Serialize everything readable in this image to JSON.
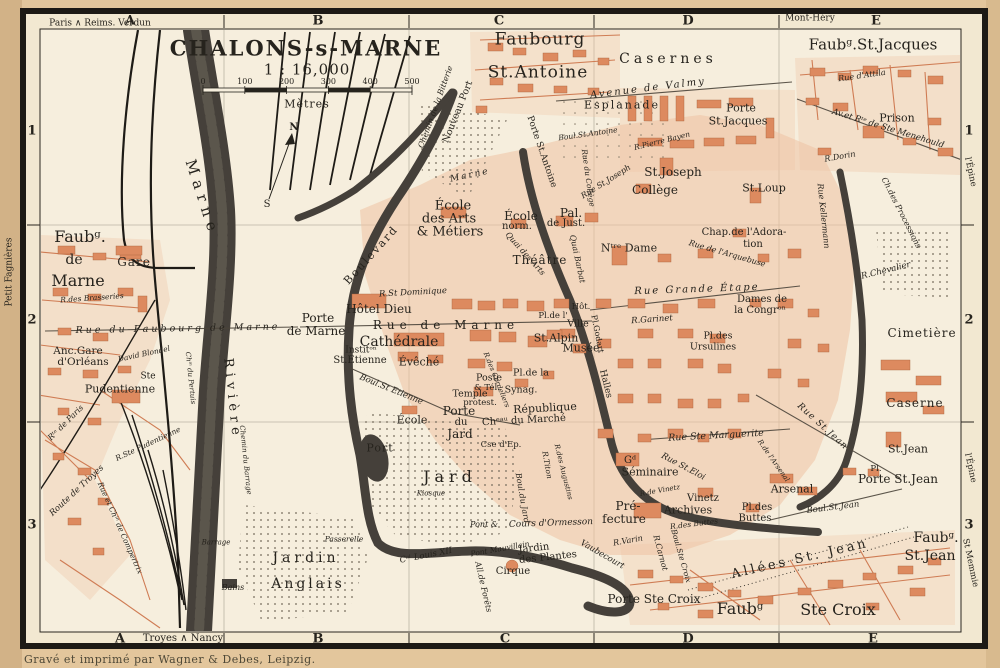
{
  "title": {
    "name": "CHALONS-s-MARNE",
    "scale": "1 : 16,000",
    "unit": "Mètres"
  },
  "scale_bar": {
    "ticks": [
      "0",
      "100",
      "200",
      "300",
      "400",
      "500"
    ]
  },
  "margins": {
    "credit": "Gravé et imprimé par Wagner & Debes, Leipzig."
  },
  "grid": {
    "cols": [
      "A",
      "B",
      "C",
      "D",
      "E"
    ],
    "col_x_top": [
      130,
      318,
      499,
      688,
      876
    ],
    "col_x_bottom": [
      120,
      318,
      505,
      688,
      873
    ],
    "rows": [
      "1",
      "2",
      "3"
    ],
    "row_y": [
      131,
      320,
      525
    ],
    "row_x_left": 32,
    "row_x_right": 969
  },
  "colors": {
    "paper": "#e3c69c",
    "sheet": "#f2e8d1",
    "field": "#f6eedd",
    "building": "#dd8a5f",
    "city_wash": "#efc3a2",
    "water": "#45403a",
    "ink": "#26231d",
    "red_ink": "#cf7c54"
  },
  "labels": [
    {
      "t": "Paris ∧ Reims. Verdun",
      "x": 100,
      "y": 24,
      "s": 9
    },
    {
      "t": "Mont-Héry",
      "x": 810,
      "y": 19,
      "s": 9
    },
    {
      "t": "Troyes ∧ Nancy",
      "x": 183,
      "y": 639,
      "s": 10
    },
    {
      "t": "Petit Fagnières",
      "x": 10,
      "y": 272,
      "s": 9,
      "r": -90
    },
    {
      "t": "l'Épine",
      "x": 970,
      "y": 172,
      "s": 8.5,
      "r": 78
    },
    {
      "t": "l'Épine",
      "x": 970,
      "y": 468,
      "s": 8.5,
      "r": 78
    },
    {
      "t": "St Memmie",
      "x": 970,
      "y": 563,
      "s": 8.5,
      "r": 78
    },
    {
      "t": "N",
      "x": 294,
      "y": 128,
      "s": 10,
      "b": 1
    },
    {
      "t": "S",
      "x": 267,
      "y": 205,
      "s": 10
    },
    {
      "t": "Faubourg",
      "x": 540,
      "y": 40,
      "s": 17,
      "ls": 1
    },
    {
      "t": "St.Antoine",
      "x": 538,
      "y": 73,
      "s": 17,
      "ls": 1
    },
    {
      "t": "Casernes",
      "x": 668,
      "y": 59,
      "s": 14,
      "ls": 4
    },
    {
      "t": "Faubᵍ.St.Jacques",
      "x": 873,
      "y": 45,
      "s": 15
    },
    {
      "t": "Rue d'Attila",
      "x": 862,
      "y": 76,
      "s": 8,
      "i": 1,
      "r": -8
    },
    {
      "t": "Avenue de Valmy",
      "x": 648,
      "y": 89,
      "s": 10,
      "i": 1,
      "r": -7,
      "ls": 2
    },
    {
      "t": "Esplanade",
      "x": 622,
      "y": 105,
      "s": 11,
      "ls": 2
    },
    {
      "t": "Porte",
      "x": 741,
      "y": 108,
      "s": 11
    },
    {
      "t": "St.Jacques",
      "x": 738,
      "y": 121,
      "s": 11
    },
    {
      "t": "Prison",
      "x": 897,
      "y": 118,
      "s": 11
    },
    {
      "t": "Av.et Rᵗᵉ de Ste Menehould",
      "x": 888,
      "y": 129,
      "s": 8.5,
      "i": 1,
      "r": 17
    },
    {
      "t": "Boul.St.Antoine",
      "x": 588,
      "y": 134,
      "s": 7.5,
      "i": 1,
      "r": -8
    },
    {
      "t": "R.Pierre Bayen",
      "x": 662,
      "y": 141,
      "s": 7.5,
      "i": 1,
      "r": -14
    },
    {
      "t": "Porte St.Antoine",
      "x": 541,
      "y": 152,
      "s": 9,
      "r": 71
    },
    {
      "t": "St.Joseph",
      "x": 673,
      "y": 172,
      "s": 12
    },
    {
      "t": "Collège",
      "x": 655,
      "y": 190,
      "s": 12
    },
    {
      "t": "Rue St.Joseph",
      "x": 606,
      "y": 182,
      "s": 8,
      "i": 1,
      "r": -32
    },
    {
      "t": "St.Loup",
      "x": 764,
      "y": 188,
      "s": 11
    },
    {
      "t": "R.Dorin",
      "x": 840,
      "y": 157,
      "s": 8,
      "i": 1,
      "r": -10
    },
    {
      "t": "Rue Kellermann",
      "x": 823,
      "y": 216,
      "s": 8,
      "i": 1,
      "r": 84
    },
    {
      "t": "Ch.des Processions",
      "x": 901,
      "y": 213,
      "s": 8,
      "i": 1,
      "r": 63
    },
    {
      "t": "R.Chevalier",
      "x": 886,
      "y": 271,
      "s": 8.5,
      "i": 1,
      "r": -14
    },
    {
      "t": "Chap.de l'Adora-",
      "x": 744,
      "y": 233,
      "s": 10
    },
    {
      "t": "tion",
      "x": 753,
      "y": 245,
      "s": 10
    },
    {
      "t": "Nᵗʳᵉ Dame",
      "x": 629,
      "y": 248,
      "s": 11
    },
    {
      "t": "Rue de l'Arquebuse",
      "x": 727,
      "y": 254,
      "s": 8,
      "i": 1,
      "r": 16
    },
    {
      "t": "Rue Grande Étape",
      "x": 697,
      "y": 290,
      "s": 10,
      "i": 1,
      "ls": 2,
      "r": -2
    },
    {
      "t": "Dames de",
      "x": 762,
      "y": 300,
      "s": 10
    },
    {
      "t": "la Congrᵒⁿ",
      "x": 760,
      "y": 311,
      "s": 10
    },
    {
      "t": "R.Garinet",
      "x": 652,
      "y": 320,
      "s": 8.5,
      "i": 1,
      "r": -4
    },
    {
      "t": "Pl.des",
      "x": 718,
      "y": 336,
      "s": 9.5
    },
    {
      "t": "Ursulines",
      "x": 713,
      "y": 347,
      "s": 9.5
    },
    {
      "t": "Cimetière",
      "x": 922,
      "y": 333,
      "s": 12,
      "ls": 1
    },
    {
      "t": "Caserne",
      "x": 915,
      "y": 403,
      "s": 12,
      "ls": 1
    },
    {
      "t": "St.Jean",
      "x": 908,
      "y": 449,
      "s": 11
    },
    {
      "t": "Pl.",
      "x": 876,
      "y": 469,
      "s": 8.5
    },
    {
      "t": "Porte St.Jean",
      "x": 898,
      "y": 479,
      "s": 12
    },
    {
      "t": "Arsenal",
      "x": 792,
      "y": 489,
      "s": 11
    },
    {
      "t": "Boul.St.Jean",
      "x": 833,
      "y": 508,
      "s": 8.5,
      "i": 1,
      "r": -7
    },
    {
      "t": "Rue St.Jean",
      "x": 822,
      "y": 427,
      "s": 9,
      "i": 1,
      "r": 42,
      "ls": 1
    },
    {
      "t": "R.de l'Arsenal",
      "x": 773,
      "y": 461,
      "s": 7,
      "i": 1,
      "r": 55
    },
    {
      "t": "Rue Ste Marguerite",
      "x": 716,
      "y": 436,
      "s": 9.5,
      "i": 1,
      "r": -3
    },
    {
      "t": "Rue St.Eloi",
      "x": 683,
      "y": 467,
      "s": 8.5,
      "i": 1,
      "r": 28
    },
    {
      "t": "Gᵈ",
      "x": 630,
      "y": 461,
      "s": 10
    },
    {
      "t": "Séminaire",
      "x": 650,
      "y": 472,
      "s": 11
    },
    {
      "t": "R.de Vinetz",
      "x": 660,
      "y": 491,
      "s": 7,
      "i": 1,
      "r": -10
    },
    {
      "t": "Vinetz",
      "x": 703,
      "y": 499,
      "s": 10
    },
    {
      "t": "Archives",
      "x": 688,
      "y": 510,
      "s": 11
    },
    {
      "t": "Pré-",
      "x": 628,
      "y": 506,
      "s": 12
    },
    {
      "t": "fecture",
      "x": 624,
      "y": 519,
      "s": 12
    },
    {
      "t": "Pl.des",
      "x": 757,
      "y": 508,
      "s": 10
    },
    {
      "t": "Buttes",
      "x": 755,
      "y": 519,
      "s": 10
    },
    {
      "t": "R.des Buttes",
      "x": 694,
      "y": 524,
      "s": 7.5,
      "i": 1,
      "r": -7
    },
    {
      "t": "R.Varin",
      "x": 628,
      "y": 541,
      "s": 8,
      "i": 1,
      "r": -10
    },
    {
      "t": "Vaubecourt",
      "x": 602,
      "y": 555,
      "s": 8.5,
      "i": 1,
      "r": 30
    },
    {
      "t": "R.Carnot",
      "x": 660,
      "y": 553,
      "s": 8,
      "i": 1,
      "r": 75
    },
    {
      "t": "Boul.Ste Croix",
      "x": 681,
      "y": 556,
      "s": 7.5,
      "i": 1,
      "r": 74
    },
    {
      "t": "Porte Ste Croix",
      "x": 654,
      "y": 599,
      "s": 12
    },
    {
      "t": "Faubᵍ",
      "x": 740,
      "y": 609,
      "s": 16
    },
    {
      "t": "Ste Croix",
      "x": 838,
      "y": 610,
      "s": 16
    },
    {
      "t": "Allées St. Jean",
      "x": 800,
      "y": 559,
      "s": 13,
      "ls": 3,
      "r": -13
    },
    {
      "t": "Faubᵍ.",
      "x": 936,
      "y": 538,
      "s": 14
    },
    {
      "t": "St.Jean",
      "x": 930,
      "y": 556,
      "s": 14
    },
    {
      "t": "Cours d'Ormesson",
      "x": 551,
      "y": 524,
      "s": 9,
      "i": 1,
      "r": -2
    },
    {
      "t": "Pont &",
      "x": 484,
      "y": 525,
      "s": 8,
      "i": 1
    },
    {
      "t": "Pont Mauvillain",
      "x": 500,
      "y": 549,
      "s": 7.5,
      "i": 1,
      "r": -10
    },
    {
      "t": "Jardin",
      "x": 534,
      "y": 549,
      "s": 10,
      "r": -6
    },
    {
      "t": "des Plantes",
      "x": 548,
      "y": 558,
      "s": 10,
      "r": -6
    },
    {
      "t": "Cirque",
      "x": 513,
      "y": 572,
      "s": 10
    },
    {
      "t": "All.de Forêts",
      "x": 483,
      "y": 587,
      "s": 8,
      "i": 1,
      "r": 77
    },
    {
      "t": "Cᵃˡ Louis XII",
      "x": 426,
      "y": 556,
      "s": 8.5,
      "i": 1,
      "r": -11
    },
    {
      "t": "Passerelle",
      "x": 344,
      "y": 539,
      "s": 7.5,
      "i": 1
    },
    {
      "t": "Jardin",
      "x": 306,
      "y": 558,
      "s": 14,
      "ls": 4
    },
    {
      "t": "Anglais",
      "x": 308,
      "y": 584,
      "s": 14,
      "ls": 3
    },
    {
      "t": "Kiosque",
      "x": 431,
      "y": 494,
      "s": 7,
      "i": 1
    },
    {
      "t": "Jard",
      "x": 450,
      "y": 477,
      "s": 16,
      "ls": 5
    },
    {
      "t": "Porte",
      "x": 459,
      "y": 411,
      "s": 12
    },
    {
      "t": "du",
      "x": 461,
      "y": 423,
      "s": 10
    },
    {
      "t": "Jard",
      "x": 460,
      "y": 434,
      "s": 12
    },
    {
      "t": "École",
      "x": 412,
      "y": 420,
      "s": 11
    },
    {
      "t": "Chᵉᵃᵘ du Marché",
      "x": 524,
      "y": 421,
      "s": 10,
      "r": -3
    },
    {
      "t": "Cse d'Ep.",
      "x": 501,
      "y": 445,
      "s": 8.5
    },
    {
      "t": "Port",
      "x": 380,
      "y": 448,
      "s": 11,
      "ls": 1
    },
    {
      "t": "Poste",
      "x": 489,
      "y": 378,
      "s": 9.5
    },
    {
      "t": "& Tél.",
      "x": 487,
      "y": 388,
      "s": 8.5
    },
    {
      "t": "Temple",
      "x": 470,
      "y": 394,
      "s": 9.5
    },
    {
      "t": "protest.",
      "x": 480,
      "y": 403,
      "s": 8.5
    },
    {
      "t": "Pl.de la",
      "x": 531,
      "y": 373,
      "s": 9.5
    },
    {
      "t": "Synag.",
      "x": 521,
      "y": 390,
      "s": 9.5
    },
    {
      "t": "République",
      "x": 545,
      "y": 408,
      "s": 11,
      "r": -3
    },
    {
      "t": "Halles",
      "x": 605,
      "y": 384,
      "s": 9,
      "r": 76
    },
    {
      "t": "Pl.Godart",
      "x": 597,
      "y": 334,
      "s": 8,
      "r": 79
    },
    {
      "t": "Pl.de l'",
      "x": 553,
      "y": 316,
      "s": 8.5
    },
    {
      "t": "Hôt.",
      "x": 581,
      "y": 307,
      "s": 8.5
    },
    {
      "t": "Ville",
      "x": 578,
      "y": 324,
      "s": 9.5
    },
    {
      "t": "St.Alpin",
      "x": 556,
      "y": 338,
      "s": 11
    },
    {
      "t": "Musée",
      "x": 581,
      "y": 348,
      "s": 11
    },
    {
      "t": "Théâtre",
      "x": 540,
      "y": 260,
      "s": 12,
      "ls": 1
    },
    {
      "t": "Pal.",
      "x": 571,
      "y": 213,
      "s": 12
    },
    {
      "t": "de Just.",
      "x": 566,
      "y": 224,
      "s": 10
    },
    {
      "t": "École",
      "x": 521,
      "y": 216,
      "s": 12
    },
    {
      "t": "norm.",
      "x": 517,
      "y": 227,
      "s": 10
    },
    {
      "t": "École",
      "x": 453,
      "y": 206,
      "s": 13
    },
    {
      "t": "des Arts",
      "x": 449,
      "y": 219,
      "s": 13
    },
    {
      "t": "& Métiers",
      "x": 450,
      "y": 232,
      "s": 13
    },
    {
      "t": "Boulevard",
      "x": 371,
      "y": 255,
      "s": 11,
      "r": -48,
      "ls": 2
    },
    {
      "t": "R.St Dominique",
      "x": 413,
      "y": 293,
      "s": 8.5,
      "i": 1,
      "r": -3
    },
    {
      "t": "Hôtel Dieu",
      "x": 379,
      "y": 309,
      "s": 12
    },
    {
      "t": "Porte",
      "x": 318,
      "y": 318,
      "s": 12
    },
    {
      "t": "de Marne",
      "x": 316,
      "y": 331,
      "s": 12
    },
    {
      "t": "Rue de Marne",
      "x": 446,
      "y": 325,
      "s": 12,
      "ls": 5
    },
    {
      "t": "Cathédrale",
      "x": 399,
      "y": 342,
      "s": 14
    },
    {
      "t": "Institᵒⁿ",
      "x": 361,
      "y": 351,
      "s": 9
    },
    {
      "t": "St.Etienne",
      "x": 360,
      "y": 361,
      "s": 10
    },
    {
      "t": "Évêché",
      "x": 419,
      "y": 362,
      "s": 11
    },
    {
      "t": "Boul.St Etienne",
      "x": 391,
      "y": 390,
      "s": 8.5,
      "i": 1,
      "r": 22
    },
    {
      "t": "R.des Cordeliers",
      "x": 496,
      "y": 380,
      "s": 7,
      "i": 1,
      "r": 68
    },
    {
      "t": "R.Titon",
      "x": 547,
      "y": 465,
      "s": 7.5,
      "i": 1,
      "r": 80
    },
    {
      "t": "R.des Augustins",
      "x": 563,
      "y": 472,
      "s": 7,
      "i": 1,
      "r": 76
    },
    {
      "t": "Boul.du Jard",
      "x": 522,
      "y": 498,
      "s": 8,
      "i": 1,
      "r": 80
    },
    {
      "t": "Rue du Collège",
      "x": 588,
      "y": 178,
      "s": 7.5,
      "i": 1,
      "r": 82
    },
    {
      "t": "Quai des Arts",
      "x": 525,
      "y": 254,
      "s": 8,
      "i": 1,
      "r": 48
    },
    {
      "t": "Quai Barbat",
      "x": 577,
      "y": 259,
      "s": 8,
      "i": 1,
      "r": 78
    },
    {
      "t": "Nouveau Port",
      "x": 458,
      "y": 112,
      "s": 9.5,
      "r": -68
    },
    {
      "t": "Chemin de la Bitterie",
      "x": 436,
      "y": 107,
      "s": 8,
      "i": 1,
      "r": -70
    },
    {
      "t": "Marne",
      "x": 470,
      "y": 176,
      "s": 9,
      "i": 1,
      "ls": 2,
      "r": -12
    },
    {
      "t": "Marne",
      "x": 202,
      "y": 198,
      "s": 15,
      "ls": 6,
      "r": 72
    },
    {
      "t": "Rivière",
      "x": 232,
      "y": 399,
      "s": 13,
      "ls": 5,
      "r": 84
    },
    {
      "t": "Chⁱⁿ du Pertuis",
      "x": 190,
      "y": 378,
      "s": 7,
      "i": 1,
      "r": 84
    },
    {
      "t": "Chemin du Barrage",
      "x": 245,
      "y": 460,
      "s": 7,
      "i": 1,
      "r": 84
    },
    {
      "t": "Barrage",
      "x": 216,
      "y": 543,
      "s": 7,
      "i": 1
    },
    {
      "t": "Bains",
      "x": 233,
      "y": 588,
      "s": 8,
      "i": 1
    },
    {
      "t": "Faubᵍ.",
      "x": 80,
      "y": 237,
      "s": 16
    },
    {
      "t": "de",
      "x": 74,
      "y": 260,
      "s": 14
    },
    {
      "t": "Marne",
      "x": 78,
      "y": 281,
      "s": 16
    },
    {
      "t": "Gare",
      "x": 134,
      "y": 262,
      "s": 12,
      "ls": 1
    },
    {
      "t": "R.des Brasseries",
      "x": 92,
      "y": 298,
      "s": 7.5,
      "i": 1,
      "r": -4
    },
    {
      "t": "Rue du Faubourg de Marne",
      "x": 178,
      "y": 329,
      "s": 9.5,
      "ls": 3,
      "i": 1,
      "r": -1
    },
    {
      "t": "Anc.Gare",
      "x": 78,
      "y": 351,
      "s": 10.5
    },
    {
      "t": "d'Orléans",
      "x": 83,
      "y": 362,
      "s": 10.5
    },
    {
      "t": "David Blondel",
      "x": 144,
      "y": 354,
      "s": 7.5,
      "i": 1,
      "r": -12
    },
    {
      "t": "Ste",
      "x": 148,
      "y": 377,
      "s": 9
    },
    {
      "t": "Pudentienne",
      "x": 120,
      "y": 389,
      "s": 11
    },
    {
      "t": "R.Ste Pudentienne",
      "x": 148,
      "y": 444,
      "s": 7.5,
      "i": 1,
      "r": -25
    },
    {
      "t": "Rᵗᵉ de Paris",
      "x": 66,
      "y": 423,
      "s": 8,
      "i": 1,
      "r": -45
    },
    {
      "t": "Route de Troyes",
      "x": 77,
      "y": 491,
      "s": 8.5,
      "i": 1,
      "r": -43
    },
    {
      "t": "Rue et Chⁱⁿ de Compertrix",
      "x": 120,
      "y": 528,
      "s": 7.5,
      "i": 1,
      "r": 66
    }
  ]
}
